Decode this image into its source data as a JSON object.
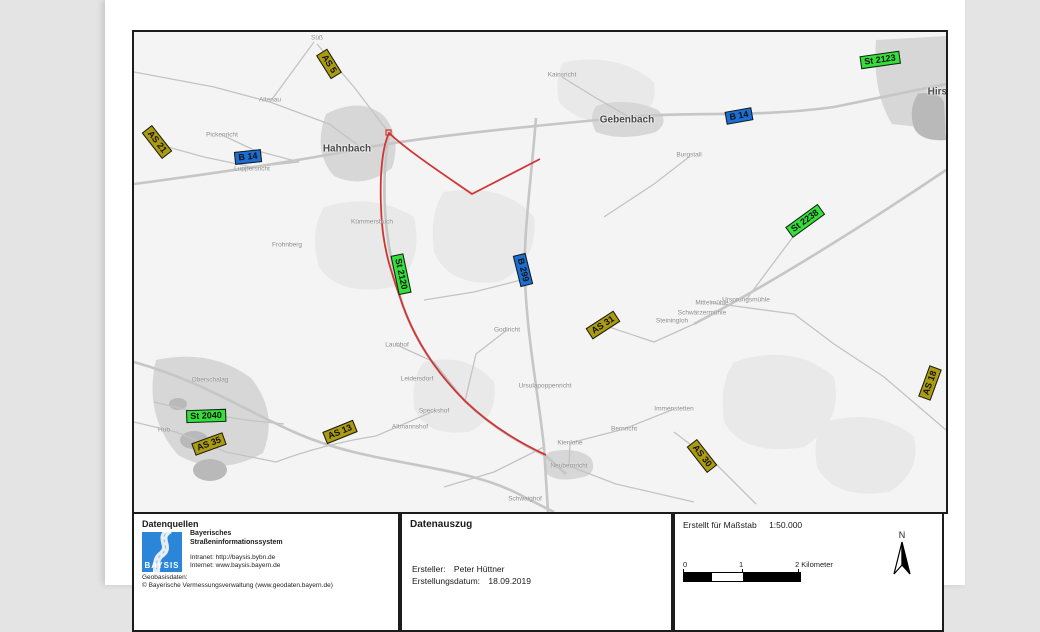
{
  "map": {
    "label_colors": {
      "AS": "#ab9b10",
      "B": "#1b6fd2",
      "St": "#35df3a"
    },
    "road_labels": [
      {
        "text": "AS 5",
        "type": "AS",
        "x": 195,
        "y": 32,
        "rot": 58
      },
      {
        "text": "AS 21",
        "type": "AS",
        "x": 23,
        "y": 110,
        "rot": 52
      },
      {
        "text": "B 14",
        "type": "B",
        "x": 114,
        "y": 125,
        "rot": -6
      },
      {
        "text": "B 14",
        "type": "B",
        "x": 605,
        "y": 84,
        "rot": -10
      },
      {
        "text": "St 2123",
        "type": "St",
        "x": 746,
        "y": 28,
        "rot": -8
      },
      {
        "text": "St 2238",
        "type": "St",
        "x": 671,
        "y": 189,
        "rot": -36
      },
      {
        "text": "St 2120",
        "type": "St",
        "x": 267,
        "y": 242,
        "rot": 78
      },
      {
        "text": "B 299",
        "type": "B",
        "x": 389,
        "y": 238,
        "rot": 76
      },
      {
        "text": "AS 31",
        "type": "AS",
        "x": 469,
        "y": 293,
        "rot": -33
      },
      {
        "text": "AS 18",
        "type": "AS",
        "x": 796,
        "y": 351,
        "rot": -70
      },
      {
        "text": "AS 30",
        "type": "AS",
        "x": 568,
        "y": 424,
        "rot": 52
      },
      {
        "text": "AS 13",
        "type": "AS",
        "x": 206,
        "y": 400,
        "rot": -22
      },
      {
        "text": "AS 35",
        "type": "AS",
        "x": 75,
        "y": 412,
        "rot": -20
      },
      {
        "text": "St 2040",
        "type": "St",
        "x": 72,
        "y": 384,
        "rot": -2
      }
    ],
    "towns": [
      {
        "text": "Hahnbach",
        "x": 213,
        "y": 117
      },
      {
        "text": "Gebenbach",
        "x": 493,
        "y": 88
      },
      {
        "text": "Hirschau",
        "x": 815,
        "y": 60
      }
    ],
    "villages": [
      {
        "text": "Süß",
        "x": 183,
        "y": 6
      },
      {
        "text": "Altenau",
        "x": 136,
        "y": 68
      },
      {
        "text": "Kainsricht",
        "x": 428,
        "y": 43
      },
      {
        "text": "Burgstall",
        "x": 555,
        "y": 123
      },
      {
        "text": "Pickenricht",
        "x": 88,
        "y": 103
      },
      {
        "text": "Luppersricht",
        "x": 118,
        "y": 137
      },
      {
        "text": "Kümmersbuch",
        "x": 238,
        "y": 190
      },
      {
        "text": "Frohnberg",
        "x": 153,
        "y": 213
      },
      {
        "text": "Godlricht",
        "x": 373,
        "y": 298
      },
      {
        "text": "Laubhof",
        "x": 263,
        "y": 313
      },
      {
        "text": "Leidersdorf",
        "x": 283,
        "y": 347
      },
      {
        "text": "Speckshof",
        "x": 300,
        "y": 379
      },
      {
        "text": "Altmannshof",
        "x": 276,
        "y": 395
      },
      {
        "text": "Ursulapoppenricht",
        "x": 411,
        "y": 354
      },
      {
        "text": "Immenstetten",
        "x": 540,
        "y": 377
      },
      {
        "text": "Bernricht",
        "x": 490,
        "y": 397
      },
      {
        "text": "Kienlohe",
        "x": 436,
        "y": 411
      },
      {
        "text": "Neubernricht",
        "x": 435,
        "y": 434
      },
      {
        "text": "Schwaighof",
        "x": 391,
        "y": 467
      },
      {
        "text": "Steiningloh",
        "x": 538,
        "y": 289
      },
      {
        "text": "Schwärzermühle",
        "x": 568,
        "y": 281
      },
      {
        "text": "Mittelmühle",
        "x": 578,
        "y": 271
      },
      {
        "text": "Ursprungsmühle",
        "x": 612,
        "y": 268
      },
      {
        "text": "Oberschalag",
        "x": 76,
        "y": 348
      },
      {
        "text": "Hub",
        "x": 30,
        "y": 398
      }
    ]
  },
  "footer": {
    "datenquellen": {
      "title": "Datenquellen",
      "logo_text": "BAYSIS",
      "org_line1": "Bayerisches",
      "org_line2": "Straßeninformationssystem",
      "intranet": "Intranet: http://baysis.bybn.de",
      "internet": "Internet: www.baysis.bayern.de",
      "geo_label": "Geobasisdaten:",
      "geo_copyright": "© Bayerische Vermessungsverwaltung (www.geodaten.bayern.de)"
    },
    "datenauszug": {
      "title": "Datenauszug",
      "ersteller_label": "Ersteller:",
      "ersteller_value": "Peter Hüttner",
      "datum_label": "Erstellungsdatum:",
      "datum_value": "18.09.2019"
    },
    "massstab": {
      "title": "Erstellt für Maßstab",
      "value": "1:50.000",
      "north_label": "N",
      "scale_ticks": [
        "0",
        "1",
        "2"
      ],
      "scale_unit": "Kilometer"
    }
  }
}
